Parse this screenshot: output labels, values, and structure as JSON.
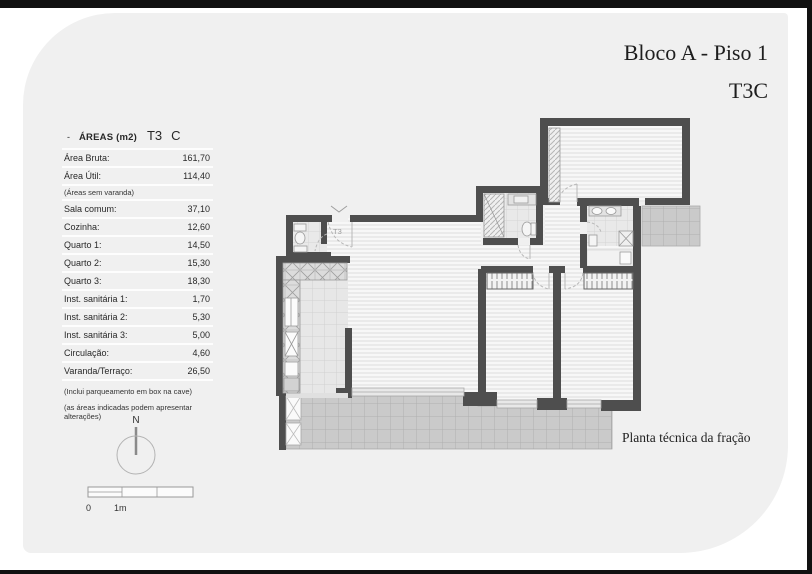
{
  "header": {
    "title": "Bloco A - Piso 1",
    "subtitle": "T3C"
  },
  "table": {
    "dash": "-",
    "title": "ÁREAS (m2)",
    "type_code": "T3",
    "variant": "C",
    "rows": [
      {
        "label": "Área Bruta:",
        "value": "161,70"
      },
      {
        "label": "Área Útil:",
        "value": "114,40"
      },
      {
        "label": "Sala comum:",
        "value": "37,10"
      },
      {
        "label": "Cozinha:",
        "value": "12,60"
      },
      {
        "label": "Quarto 1:",
        "value": "14,50"
      },
      {
        "label": "Quarto 2:",
        "value": "15,30"
      },
      {
        "label": "Quarto 3:",
        "value": "18,30"
      },
      {
        "label": "Inst. sanitária 1:",
        "value": "1,70"
      },
      {
        "label": "Inst. sanitária 2:",
        "value": "5,30"
      },
      {
        "label": "Inst. sanitária 3:",
        "value": "5,00"
      },
      {
        "label": "Circulação:",
        "value": "4,60"
      },
      {
        "label": "Varanda/Terraço:",
        "value": "26,50"
      }
    ],
    "note_after_util": "(Áreas sem varanda)",
    "footnotes": [
      "(Inclui parqueamento em box na cave)",
      "(as áreas indicadas podem apresentar alterações)"
    ]
  },
  "plan": {
    "caption": "Planta técnica da fração",
    "entry_label": "T3"
  },
  "compass": {
    "label": "N"
  },
  "scale": {
    "zero_label": "0",
    "meter_label": "1m"
  },
  "colors": {
    "card_bg": "#f0f0f0",
    "frame": "#111111",
    "wall": "#4e4e4e",
    "floor_hatch": "#dedede",
    "terrace_tile": "#cacaca",
    "text": "#222222"
  }
}
